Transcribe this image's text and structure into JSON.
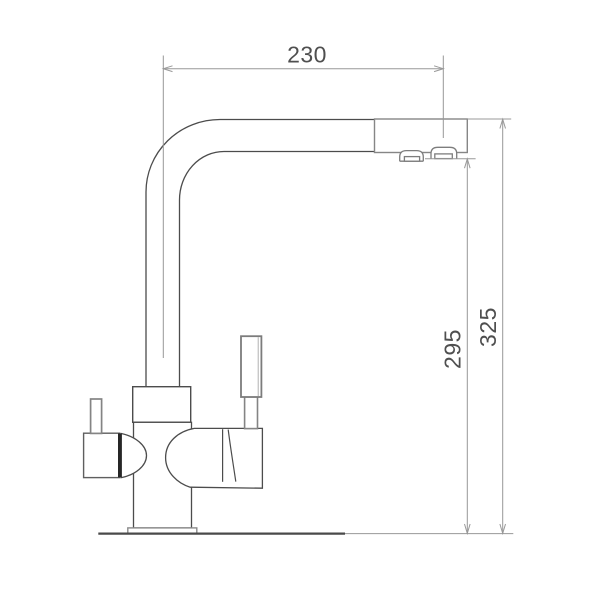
{
  "drawing": {
    "subject": "kitchen-faucet-side-view-technical-drawing"
  },
  "dimensions": {
    "reach": {
      "label": "230",
      "orientation": "horizontal"
    },
    "outlet_height": {
      "label": "295",
      "orientation": "vertical"
    },
    "total_height": {
      "label": "325",
      "orientation": "vertical"
    }
  },
  "colors": {
    "background": "#ffffff",
    "outline": "#4c4c4c",
    "light_outline": "#868686",
    "dimension_line": "#989898",
    "label_text": "#4f4f4f",
    "handle_accent": "#262626"
  }
}
